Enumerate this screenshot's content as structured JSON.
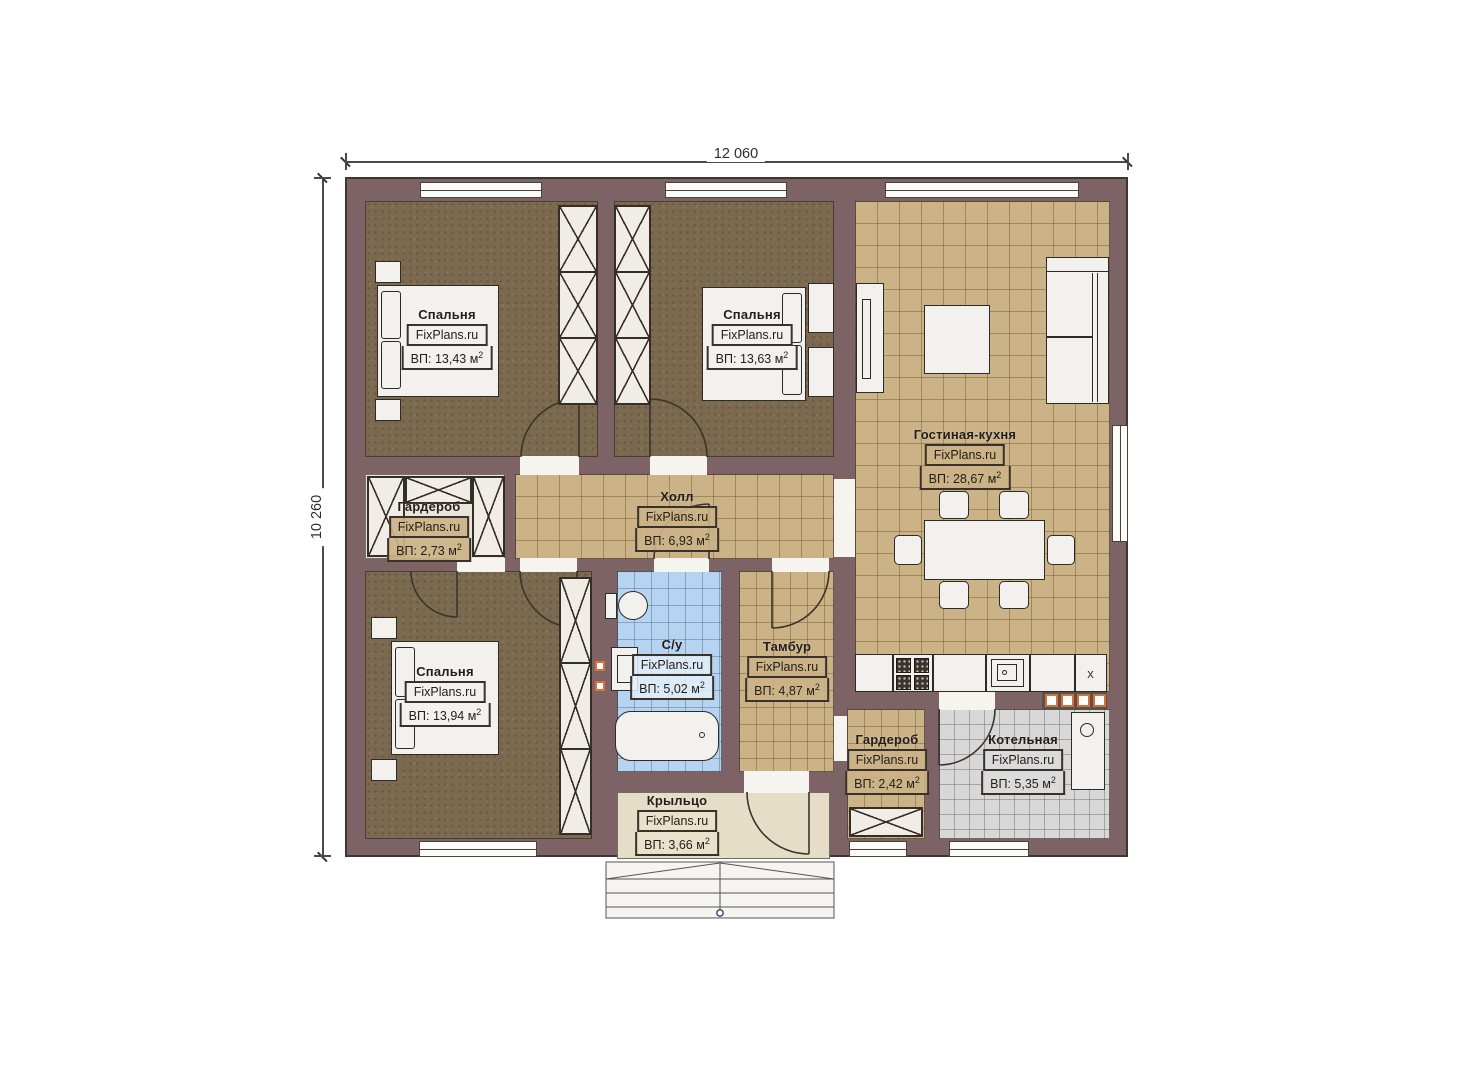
{
  "dimensions": {
    "width_label": "12 060",
    "height_label": "10 260"
  },
  "rooms": [
    {
      "name": "Спальня",
      "brand": "FixPlans.ru",
      "area": "ВП: 13,43 м",
      "sup": "2"
    },
    {
      "name": "Спальня",
      "brand": "FixPlans.ru",
      "area": "ВП: 13,63 м",
      "sup": "2"
    },
    {
      "name": "Гостиная-кухня",
      "brand": "FixPlans.ru",
      "area": "ВП: 28,67 м",
      "sup": "2"
    },
    {
      "name": "Гардероб",
      "brand": "FixPlans.ru",
      "area": "ВП: 2,73 м",
      "sup": "2"
    },
    {
      "name": "Холл",
      "brand": "FixPlans.ru",
      "area": "ВП: 6,93 м",
      "sup": "2"
    },
    {
      "name": "Спальня",
      "brand": "FixPlans.ru",
      "area": "ВП: 13,94 м",
      "sup": "2"
    },
    {
      "name": "С/у",
      "brand": "FixPlans.ru",
      "area": "ВП: 5,02 м",
      "sup": "2"
    },
    {
      "name": "Тамбур",
      "brand": "FixPlans.ru",
      "area": "ВП: 4,87 м",
      "sup": "2"
    },
    {
      "name": "Гардероб",
      "brand": "FixPlans.ru",
      "area": "ВП: 2,42 м",
      "sup": "2"
    },
    {
      "name": "Котельная",
      "brand": "FixPlans.ru",
      "area": "ВП: 5,35 м",
      "sup": "2"
    },
    {
      "name": "Крыльцо",
      "brand": "FixPlans.ru",
      "area": "ВП: 3,66 м",
      "sup": "2"
    }
  ],
  "markers": {
    "kitchen_corner": "x"
  },
  "colors": {
    "wall": "#7d6366",
    "floor_tan": "#cbb287",
    "floor_brown": "#7b6a50",
    "floor_blue": "#b6d3ef",
    "floor_gray": "#d8d8d8",
    "accent_orange": "#d96f35"
  }
}
